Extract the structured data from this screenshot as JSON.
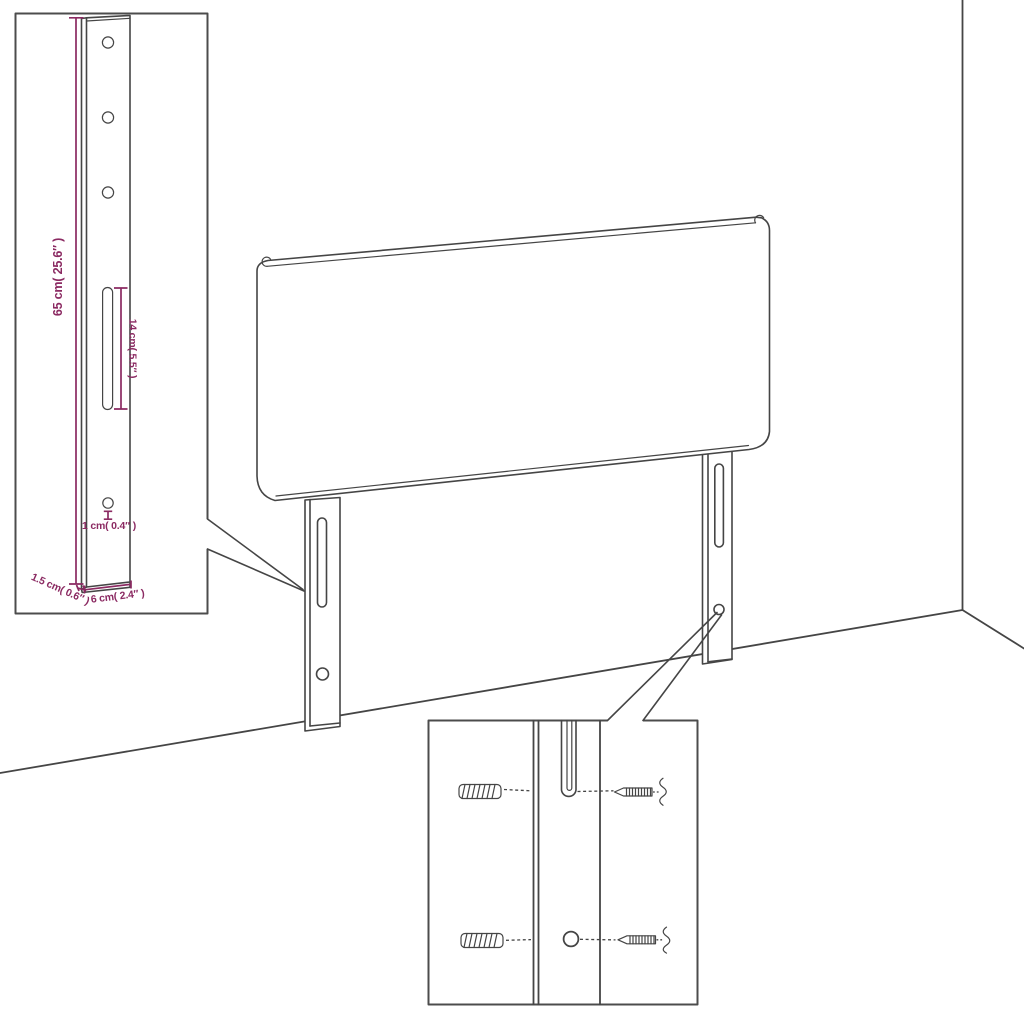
{
  "diagram": {
    "kind": "headboard-assembly-dimension-diagram",
    "colors": {
      "line": "#454545",
      "box_border": "#4c4c4c",
      "dimension": "#8b2a62",
      "background": "#ffffff"
    },
    "leg_detail_inset": {
      "dimensions": {
        "height": "65 cm( 25.6″ )",
        "slot": "14 cm( 5.5″ )",
        "hole": "1 cm( 0.4″ )",
        "width": "6 cm( 2.4″ )",
        "thickness": "1.5 cm( 0.6″ )"
      }
    }
  }
}
